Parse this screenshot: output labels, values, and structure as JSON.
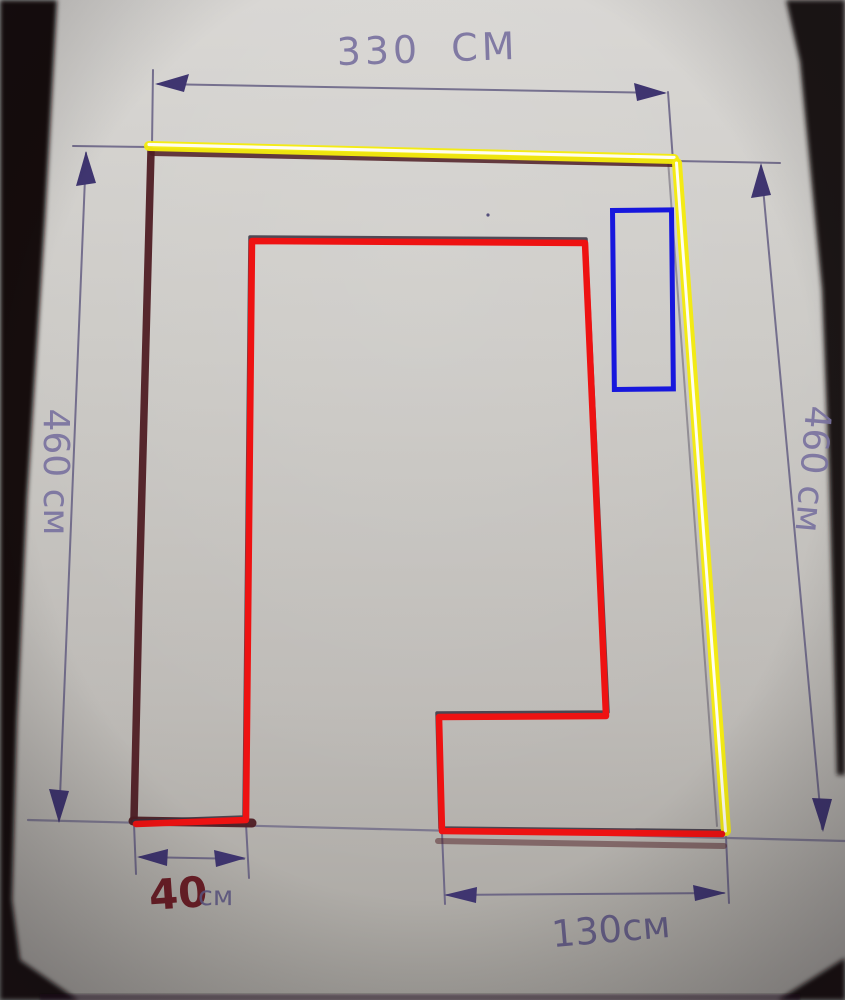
{
  "sketch": {
    "description": "hand-drawn room plan sketch on paper with measurements",
    "dimensions": {
      "top_width": "330 СМ",
      "left_height": "460 см",
      "right_height": "460 см",
      "bottom_left_width_value": "40",
      "bottom_left_width_unit": "см",
      "bottom_right_width": "130см"
    },
    "annotations": {
      "red_outline": "red room interior outline",
      "yellow_highlight": "yellow highlighted top and right walls",
      "blue_rectangle": "blue rectangle marker",
      "maroon_wall": "dark red hand-drawn wall line"
    },
    "colors": {
      "red": "#ee1212",
      "yellow": "#f4eb0e",
      "blue": "#1717dd",
      "maroon": "#4f1d24",
      "ink": "#5f5884",
      "arrow": "#3f3570",
      "paper": "#c7c4c0",
      "background": "#140f13"
    }
  }
}
